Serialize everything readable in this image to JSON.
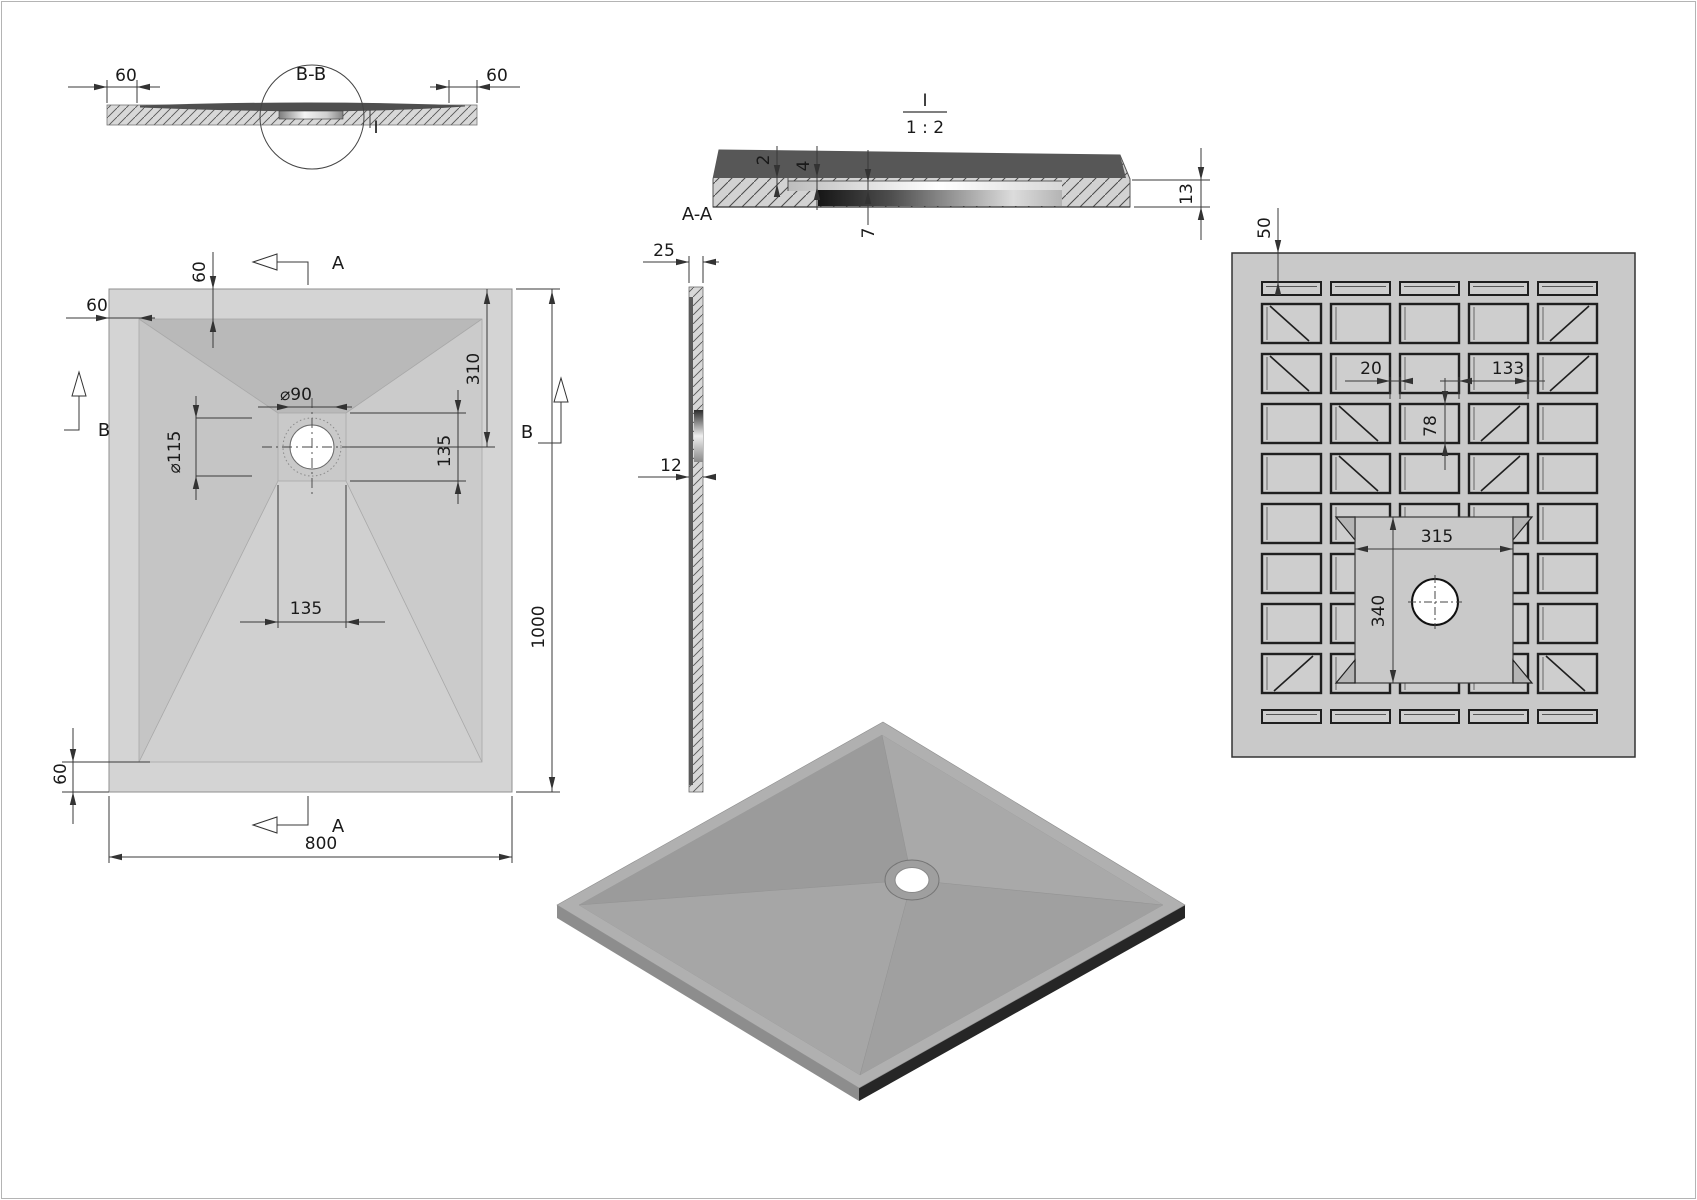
{
  "drawing": {
    "section_bb": {
      "title": "B-B",
      "detail_marker": "I",
      "dim_rim_left": "60",
      "dim_rim_right": "60"
    },
    "detail_i": {
      "name": "I",
      "scale": "1 : 2",
      "section_label": "A-A",
      "dim_step": "2",
      "dim_seat_depth": "4",
      "dim_recess_depth": "7",
      "dim_edge_thickness": "13"
    },
    "side_section": {
      "dim_top_thickness": "25",
      "dim_mid_thickness": "12"
    },
    "plan": {
      "section_arrow_top": "A",
      "section_arrow_bottom": "A",
      "section_marker_left": "B",
      "section_marker_right": "B",
      "dim_rim_left": "60",
      "dim_rim_top": "60",
      "dim_drain_diameter": "⌀90",
      "dim_flange_diameter": "⌀115",
      "dim_drain_square_height": "135",
      "dim_drain_offset_top": "310",
      "dim_length": "1000",
      "dim_drain_square_width": "135",
      "dim_rim_bottom": "60",
      "dim_width": "800"
    },
    "bottom_view": {
      "dim_edge_margin": "50",
      "dim_rib_gap": "20",
      "dim_rib_pitch": "133",
      "dim_rib_height": "78",
      "dim_recess_width": "315",
      "dim_recess_height": "340"
    },
    "colors": {
      "tray_rim": "#d4d4d4",
      "slope_dark": "#b9b9b9",
      "slope_mid": "#c5c5c5",
      "slope_light": "#d0d0d0",
      "bottom_bg": "#c9c9c9",
      "rib_fill": "#cecece",
      "iso_top": "#a6a6a6",
      "iso_side_dark": "#262626",
      "iso_side_light": "#8d8d8d",
      "hatch_line": "#555555"
    }
  }
}
